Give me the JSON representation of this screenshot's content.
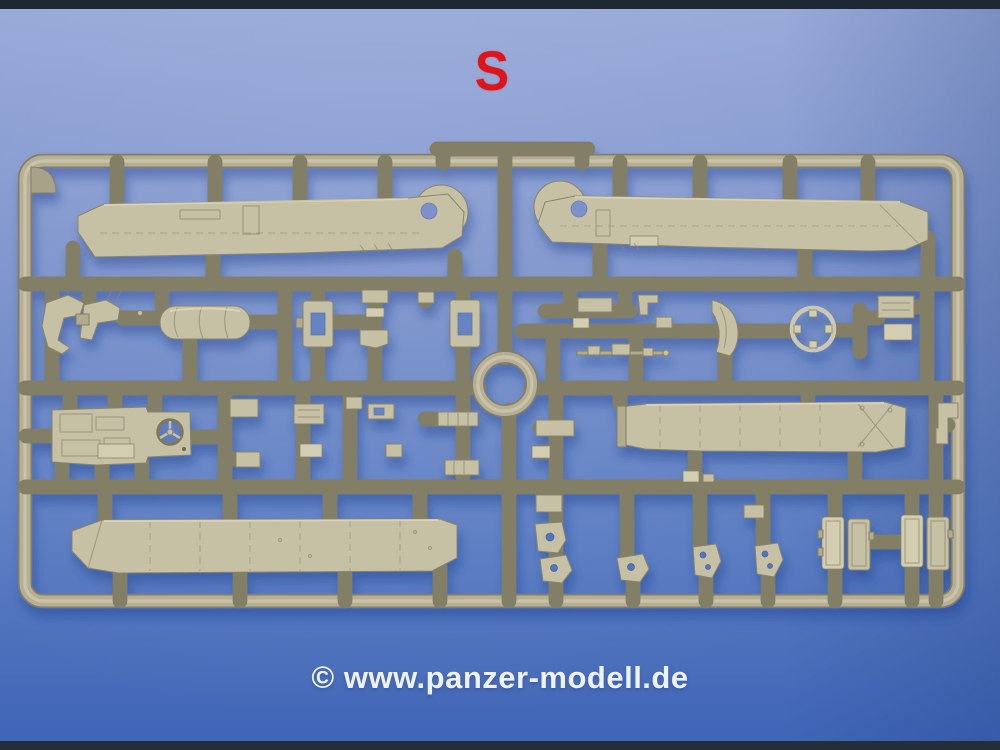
{
  "photo": {
    "description": "Photograph of a tan injection-molded plastic model kit sprue (parts frame S) of an armored vehicle kit, lying on a blue background with dark edge strips top and bottom",
    "sprue_label": "S",
    "watermark": "© www.panzer-modell.de",
    "colors": {
      "background_top": "#97a8d8",
      "background_mid": "#6e88c8",
      "background_bottom": "#3f64b6",
      "edge_strip": "#1e2832",
      "label_red": "#e0151a",
      "watermark_white": "#eef2f7",
      "plastic_main": "#b6af95",
      "plastic_dark": "#847e66",
      "plastic_light": "#d9d3b8",
      "plastic_part": "#c6c0a4",
      "shadow_blue": "#1e3d8c"
    }
  }
}
